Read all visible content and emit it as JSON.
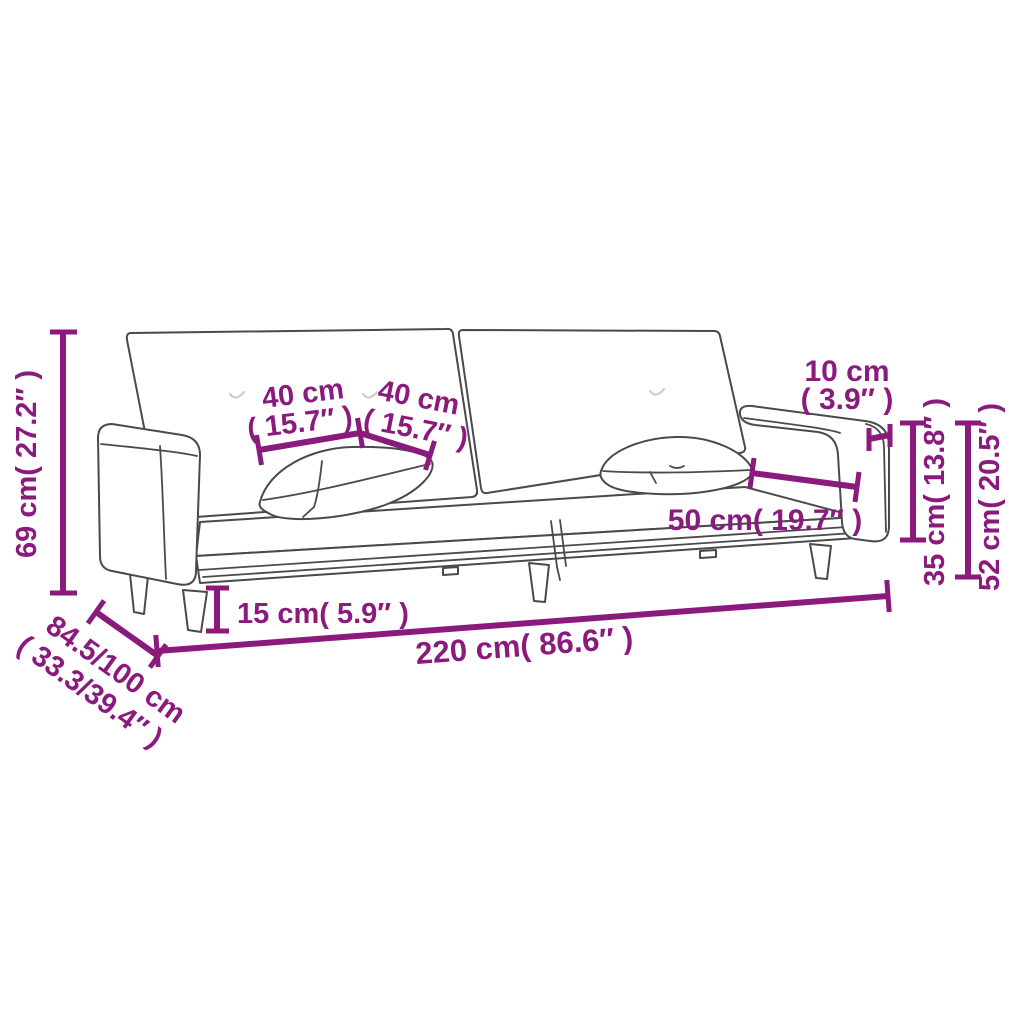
{
  "page": {
    "kind": "product-dimension-diagram",
    "subject": "two-seater sofa bed with two pillows",
    "background": "#ffffff"
  },
  "colors": {
    "dimension_accent": "#8B1A7D",
    "line_art": "#4a4a4a"
  },
  "dimensions": {
    "overall_height": {
      "label": "69 cm( 27.2″ )",
      "value_cm": 69,
      "value_in": 27.2
    },
    "overall_depth": {
      "label_line1": "84.5/100 cm",
      "label_line2": "( 33.3/39.4″ )",
      "value_cm": "84.5/100",
      "value_in": "33.3/39.4"
    },
    "pillow_left_width": {
      "label_line1": "40 cm",
      "label_line2": "( 15.7″ )",
      "value_cm": 40,
      "value_in": 15.7
    },
    "pillow_right_width": {
      "label_line1": "40 cm",
      "label_line2": "( 15.7″ )",
      "value_cm": 40,
      "value_in": 15.7
    },
    "armrest_top_width": {
      "label_line1": "10 cm",
      "label_line2": "( 3.9″ )",
      "value_cm": 10,
      "value_in": 3.9
    },
    "armrest_height": {
      "label": "35 cm( 13.8″ )",
      "value_cm": 35,
      "value_in": 13.8
    },
    "backrest_height": {
      "label": "52 cm( 20.5″ )",
      "value_cm": 52,
      "value_in": 20.5
    },
    "seat_depth": {
      "label": "50 cm( 19.7″ )",
      "value_cm": 50,
      "value_in": 19.7
    },
    "leg_height": {
      "label": "15 cm( 5.9″ )",
      "value_cm": 15,
      "value_in": 5.9
    },
    "overall_width": {
      "label": "220 cm( 86.6″ )",
      "value_cm": 220,
      "value_in": 86.6
    }
  }
}
